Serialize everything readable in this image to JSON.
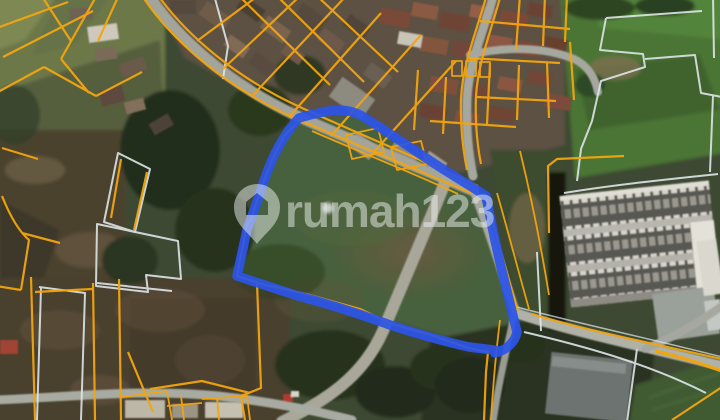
{
  "map": {
    "view": "satellite-with-cadastral-overlay",
    "watermark": {
      "text": "rumah123",
      "icon": "location-pin-house-icon",
      "color": "#EDF1F0",
      "opacity": 0.5
    },
    "overlay_colors": {
      "highlight": "#2B55E8",
      "cadastral": "#F2A50F",
      "secondary_boundary": "#DDE5E8"
    },
    "highlight": {
      "shape": "freehand-parcel-outline",
      "stroke_width": 9.5
    }
  }
}
